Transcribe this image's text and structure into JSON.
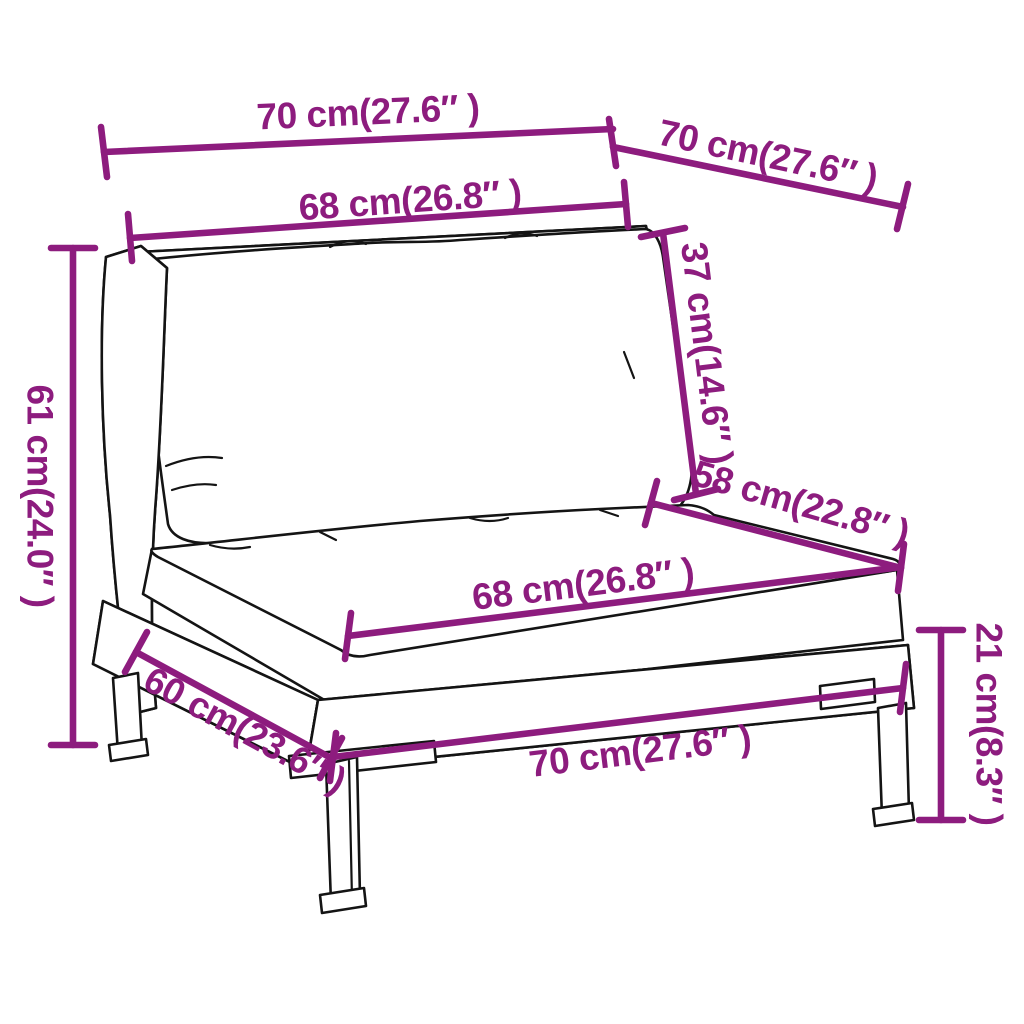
{
  "subject": "isometric line drawing of a poly rattan garden sofa middle section with back cushion, seat cushion, woven base and legs",
  "colors": {
    "dimension_annotation": "#8d1c7e",
    "artwork_line": "#141414",
    "background": "#ffffff"
  },
  "dims": [
    {
      "name": "overall-width-top",
      "label": "70 cm(27.6″ )"
    },
    {
      "name": "overall-depth-top",
      "label": "70 cm(27.6″ )"
    },
    {
      "name": "back-cushion-width",
      "label": "68 cm(26.8″ )"
    },
    {
      "name": "back-cushion-height",
      "label": "37 cm(14.6″ )"
    },
    {
      "name": "seat-depth",
      "label": "58 cm(22.8″ )"
    },
    {
      "name": "seat-cushion-width",
      "label": "68 cm(26.8″ )"
    },
    {
      "name": "base-depth",
      "label": "60 cm(23.6″ )"
    },
    {
      "name": "base-width",
      "label": "70 cm(27.6″ )"
    },
    {
      "name": "overall-height",
      "label": "61 cm(24.0″ )"
    },
    {
      "name": "leg-height",
      "label": "21 cm(8.3″ )"
    }
  ]
}
